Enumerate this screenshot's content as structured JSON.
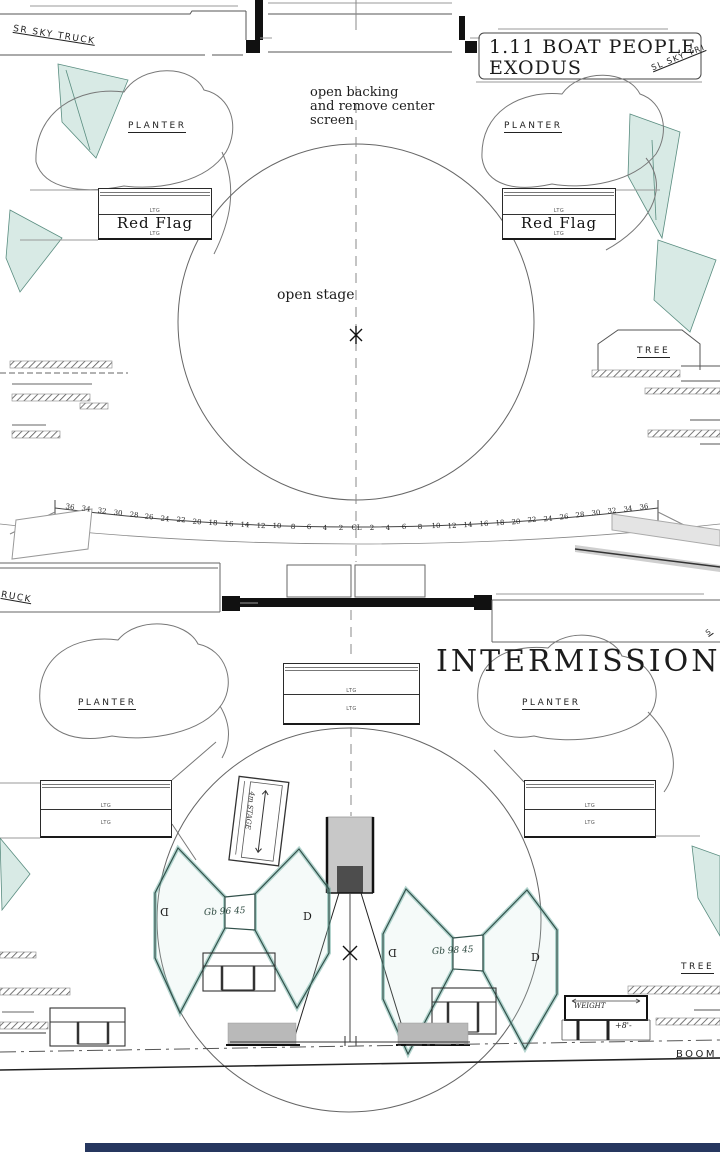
{
  "top": {
    "sr_sky_truck": "SR SKY TRUCK",
    "sl_sky_truck": "SL SKY TRI",
    "title": {
      "line1": "1.11 BOAT PEOPLE",
      "line2": "EXODUS"
    },
    "note": {
      "line1": "open backing",
      "line2": "and remove center",
      "line3": "screen"
    },
    "planter_left": "PLANTER",
    "planter_right": "PLANTER",
    "flag_left": {
      "ltg_top": "LTG",
      "label": "Red Flag",
      "ltg_bottom": "LTG"
    },
    "flag_right": {
      "ltg_top": "LTG",
      "label": "Red Flag",
      "ltg_bottom": "LTG"
    },
    "open_stage": "open stage",
    "tree": "TREE",
    "seating": {
      "numbers": [
        "36",
        "34",
        "32",
        "30",
        "28",
        "26",
        "24",
        "22",
        "20",
        "18",
        "16",
        "14",
        "12",
        "10",
        "8",
        "6",
        "4",
        "2",
        "CL",
        "2",
        "4",
        "6",
        "8",
        "10",
        "12",
        "14",
        "16",
        "18",
        "20",
        "22",
        "24",
        "26",
        "28",
        "30",
        "32",
        "34",
        "36"
      ]
    }
  },
  "middle": {
    "truck_label": "RUCK",
    "sky_truck_hint": "S"
  },
  "bottom": {
    "title": "INTERMISSION",
    "planter_left": "PLANTER",
    "planter_right": "PLANTER",
    "ltg_box_center": {
      "ltg_top": "LTG",
      "ltg_bottom": "LTG"
    },
    "ltg_box_left": {
      "ltg_top": "LTG",
      "ltg_bottom": "LTG"
    },
    "ltg_box_right": {
      "ltg_top": "LTG",
      "ltg_bottom": "LTG"
    },
    "ladder_note": "4m STAGE",
    "bowtie_left": {
      "d_outer": "D",
      "d_inner": "D",
      "note": "Gb 96 45"
    },
    "bowtie_right": {
      "d_outer": "D",
      "d_inner": "D",
      "note": "Gb 98 45"
    },
    "weight_label": "WEIGHT",
    "height_note": "+8'-",
    "tree": "TREE",
    "boom_label": "BOOM TR"
  },
  "colors": {
    "paper": "#ffffff",
    "line": "#555555",
    "dark_line": "#222222",
    "teal_fill": "#d8eae5",
    "teal_stroke": "#5a8d80",
    "platform_stroke": "#31504a",
    "gray_fill": "#c8c8c8",
    "dark_gray": "#4d4d4d",
    "bar_gray": "#b9b9b9",
    "navy_bar": "#26375f",
    "handwriting": "#2a463d"
  }
}
